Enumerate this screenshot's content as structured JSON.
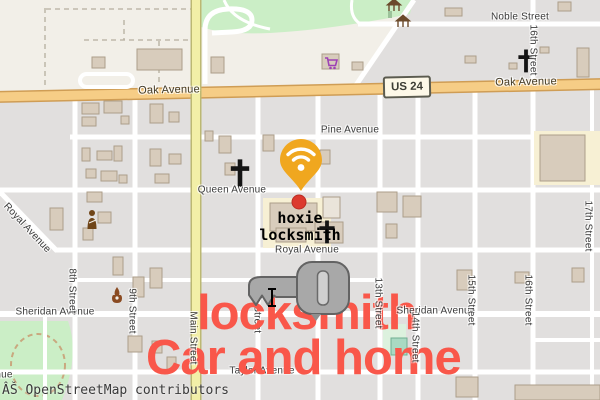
{
  "map": {
    "attribution": "ÂŠ OpenStreetMap contributors",
    "shield": "US 24",
    "avenues": {
      "noble": "Noble Street",
      "oak_left": "Oak Avenue",
      "oak_right": "Oak Avenue",
      "pine": "Pine Avenue",
      "queen": "Queen Avenue",
      "royal": "Royal Avenue",
      "royal_diagonal": "Royal Avenue",
      "sheridan_left": "Sheridan Avenue",
      "sheridan_right": "Sheridan Avenue",
      "taylor": "Taylor Avenue"
    },
    "streets": {
      "main": "Main Street",
      "s8": "8th Street",
      "s9": "9th Street",
      "s11": "11th Street",
      "s13": "13th Street",
      "s14": "14th Street",
      "s15": "15th Street",
      "s16_top": "16th Street",
      "s16": "16th Street",
      "s17": "17th Street"
    }
  },
  "poi": {
    "name_line1": "hoxie",
    "name_line2": "locksmith"
  },
  "overlay_text": {
    "line1": "locksmith",
    "line2": "Car and home",
    "color": "#f9574a"
  },
  "icons": {
    "marker": "wifi-location-pin",
    "marker_color": "#f0a71f",
    "key": "key-icon",
    "key_color": "#a8a8a8",
    "poi_dot": "red-dot-marker",
    "poi_dot_color": "#dc3a2e",
    "church": "christian-cross-icon",
    "supermarket": "shopping-cart-icon",
    "fire_station": "flame-icon",
    "hairdresser": "person-icon",
    "park_shelter": "picnic-shelter-icon"
  },
  "colors": {
    "land": "#f2efe8",
    "blocks": "#e1dfde",
    "park": "#cbeec6",
    "primary_road": "#f6cd86",
    "tertiary_road": "#f2efa7",
    "parcel": "#f7f0d4"
  }
}
